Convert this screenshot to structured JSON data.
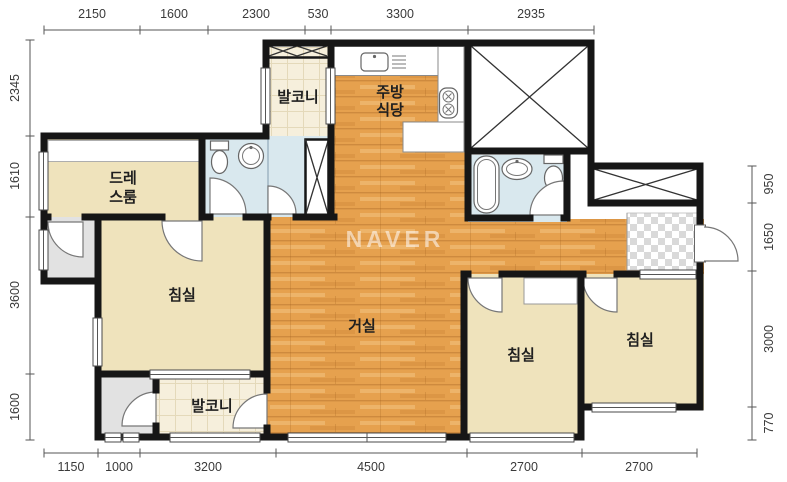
{
  "watermark": "NAVER",
  "plan": {
    "rooms": {
      "balcony_top": "발코니",
      "kitchen": {
        "line1": "주방",
        "line2": "식당"
      },
      "dressroom": {
        "line1": "드레",
        "line2": "스룸"
      },
      "bedroom_left": "침실",
      "living_room": "거실",
      "bedroom_middle": "침실",
      "bedroom_right": "침실",
      "balcony_bottom": "발코니"
    },
    "dimensions_mm": {
      "top": [
        "2150",
        "1600",
        "2300",
        "530",
        "3300",
        "2935"
      ],
      "left": [
        "2345",
        "1610",
        "3600",
        "1600"
      ],
      "right": [
        "950",
        "1650",
        "3000",
        "770"
      ],
      "bottom": [
        "1150",
        "1000",
        "3200",
        "4500",
        "2700",
        "2700"
      ]
    }
  },
  "icons": {
    "stove": "stove-burners-icon",
    "kitchen_sink": "kitchen-sink-icon",
    "dish_rack": "dish-rack-icon",
    "toilet": "toilet-icon",
    "washbasin": "washbasin-icon",
    "bathtub": "bathtub-icon",
    "door": "door-arc-icon",
    "window": "window-icon",
    "shaft": "shaft-x-hatch-icon",
    "entrance_tile": "entrance-checker-tile"
  },
  "colors": {
    "wall": "#161616",
    "wood": "#E6A14E",
    "wood_streak": "#C9873B",
    "cream": "#EFE3BC",
    "tile": "#F6EFDC",
    "bath_blue": "#D9E8EE",
    "gray_room": "#E2E2E2",
    "checker_gray": "#D9D9D9",
    "dim_text": "#3A3A3A",
    "label_text": "#1F1F1F"
  }
}
